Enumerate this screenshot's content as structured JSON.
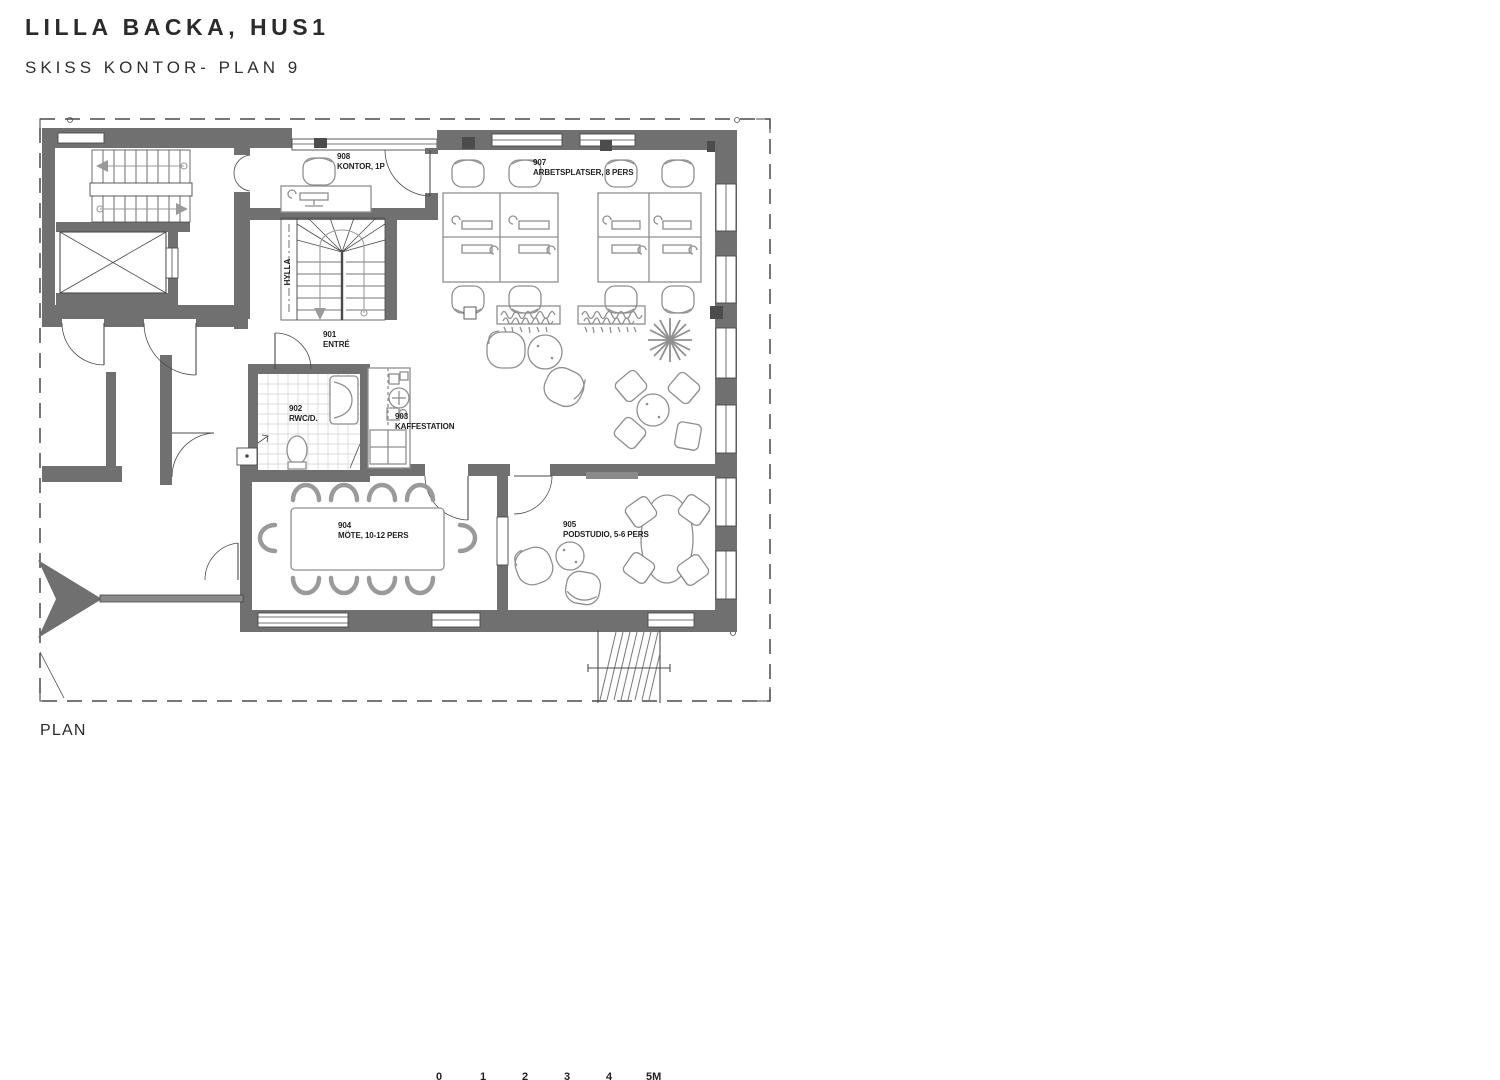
{
  "header": {
    "title": "LILLA BACKA, HUS1",
    "subtitle": "SKISS KONTOR- PLAN 9"
  },
  "plan": {
    "caption": "PLAN",
    "shelf_label": "HYLLA",
    "rooms": [
      {
        "number": "908",
        "name": "KONTOR, 1P"
      },
      {
        "number": "907",
        "name": "ARBETSPLATSER, 8 PERS"
      },
      {
        "number": "901",
        "name": "ENTRÉ"
      },
      {
        "number": "902",
        "name": "RWC/D."
      },
      {
        "number": "903",
        "name": "KAFFESTATION"
      },
      {
        "number": "904",
        "name": "MÖTE, 10-12 PERS"
      },
      {
        "number": "905",
        "name": "PODSTUDIO, 5-6 PERS"
      }
    ],
    "scale_bar": {
      "labels": [
        "0",
        "1",
        "2",
        "3",
        "4",
        "5M"
      ]
    }
  },
  "colors": {
    "wall": "#707070",
    "line": "#4a4a4a",
    "furniture": "#8f8f8f",
    "text": "#1f1f1f",
    "tile": "#d2d2d2",
    "accent": "#2b2b2b"
  }
}
